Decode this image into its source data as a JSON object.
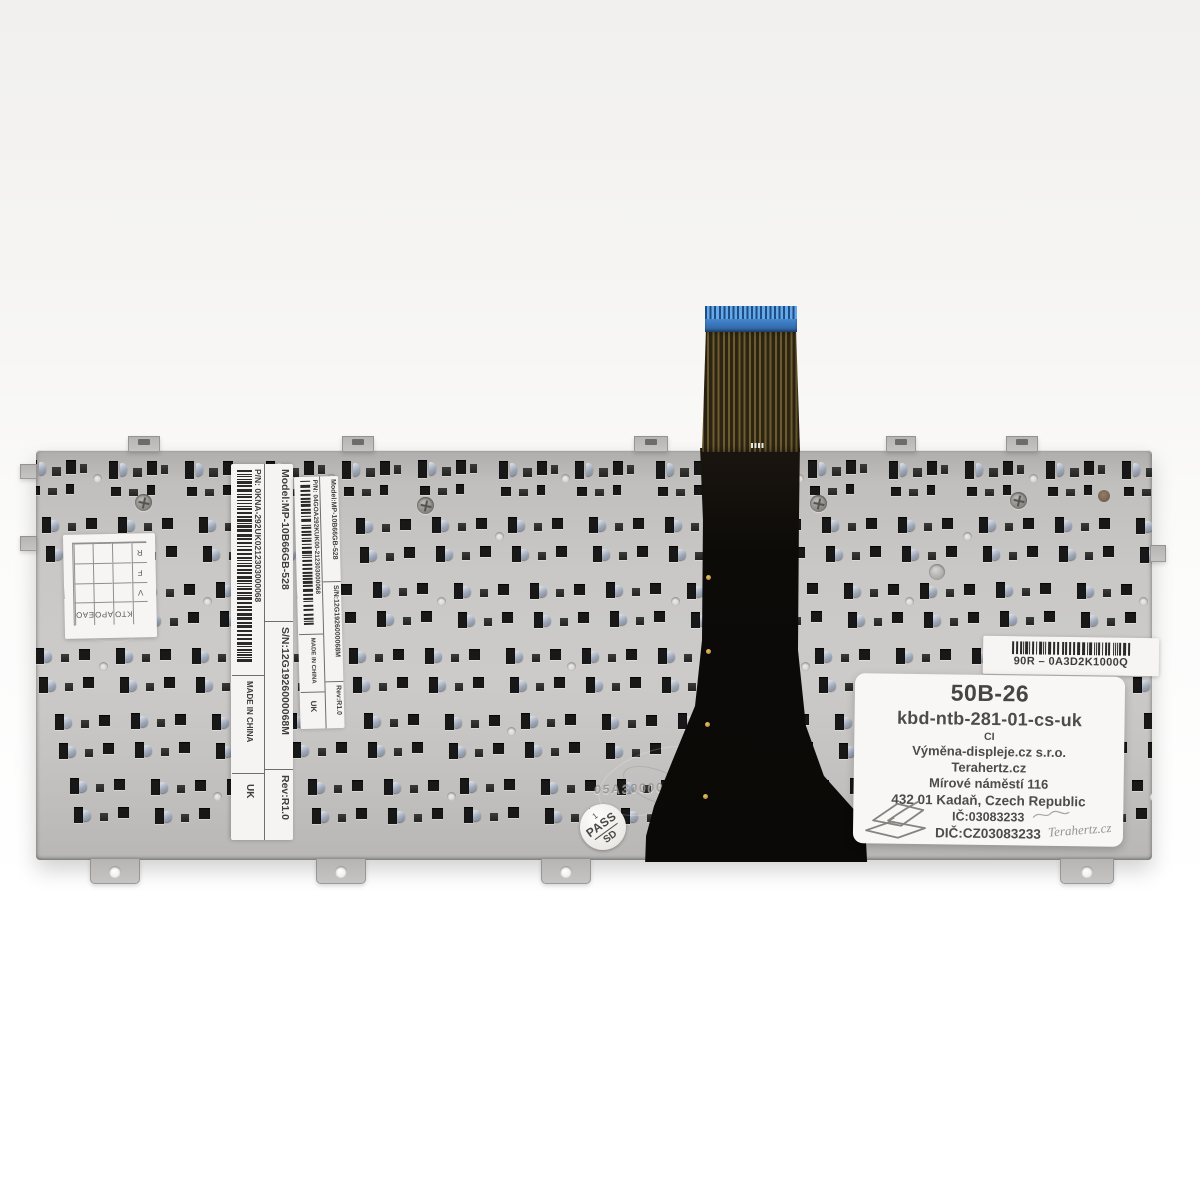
{
  "stickers": {
    "grid": {
      "right_column": [
        "R",
        "F",
        "V"
      ],
      "bottom_row": [
        "EAO",
        "APO",
        "KTO"
      ]
    },
    "outer": {
      "model": "Model:MP-10B66GB-528",
      "serial": "S/N:12G1926000068M",
      "rev": "Rev:R1.0",
      "part": "P/N: 0KNA-292UK0212303000068",
      "made_in": "MADE IN CHINA",
      "market": "UK"
    },
    "inner": {
      "model": "Model:MP-10B66GB-528",
      "serial": "S/N:12G1926000068M",
      "rev": "Rev:R1.0",
      "part": "P/N: 04GOA292KUK00-212303000068",
      "made_in": "MADE IN CHINA",
      "market": "UK"
    },
    "part_number": {
      "code": "90R – 0A3D2K1000Q"
    },
    "pass": {
      "top": "1",
      "middle": "PASS",
      "bottom": "SD"
    },
    "info": {
      "product_code": "50B-26",
      "sku": "kbd-ntb-281-01-cs-uk",
      "note": "CI",
      "company": "Výměna-displeje.cz s.r.o.",
      "brand": "Terahertz.cz",
      "street": "Mírové náměstí 116",
      "city": "432 01 Kadaň, Czech Republic",
      "company_id": "IČ:03083233",
      "vat_id": "DIČ:CZ03083233",
      "signature": "Terahertz.cz"
    }
  },
  "engraving": {
    "stamp": "05A30000LH 01"
  },
  "colors": {
    "plate": "#c9c8c6",
    "slot_dark": "#181818",
    "slot_gray": "#3a3a38",
    "steel_hook": "#9aa4b4",
    "cable_black": "#0b0907",
    "cable_blue": "#4287cd",
    "flex_trace": "#6f5c2e",
    "label_bg": "#f7f6f4",
    "label_text": "#4c4c4a"
  }
}
